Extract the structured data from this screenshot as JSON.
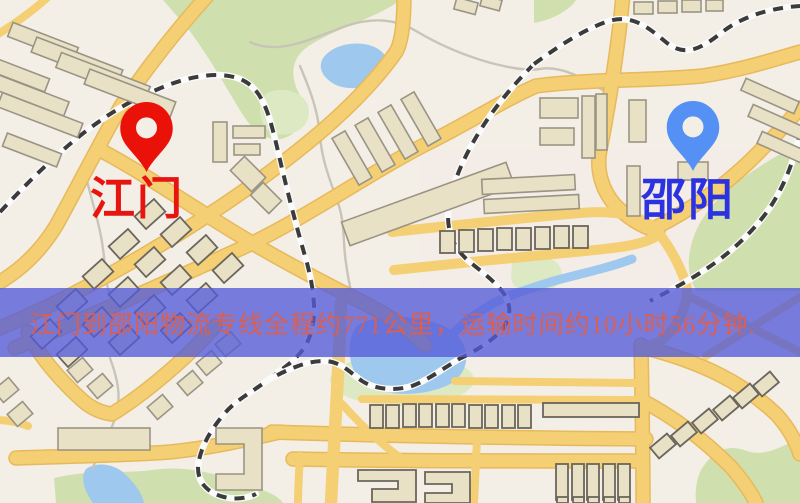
{
  "map": {
    "origin": {
      "label": "江门"
    },
    "destination": {
      "label": "邵阳"
    },
    "banner": {
      "text": "江门到邵阳物流专线全程约771公里，运输时间约10小时56分钟."
    }
  },
  "icons": {
    "origin_pin": "map-pin",
    "destination_pin": "map-pin"
  },
  "colors": {
    "map-bg": "#f3efe7",
    "road": "#f5cf74",
    "road-edge": "#e7b95c",
    "park": "#cfe0ae",
    "park-light": "#dde9c2",
    "water": "#9ec8ee",
    "building": "#e9e1c6",
    "building-edge": "#9a9484",
    "building-edge-dark": "#6b665c",
    "rail-dark": "#3b3b3b",
    "rail-light": "#fbfbfb",
    "stream": "#c9c4b8",
    "banner-bg": "rgba(83,91,216,0.78)",
    "banner-text": "#d95f53",
    "origin-label": "#e81410",
    "destination-label": "#2b33e0",
    "origin-pin": "#ea1208",
    "destination-pin": "#5590f5"
  }
}
